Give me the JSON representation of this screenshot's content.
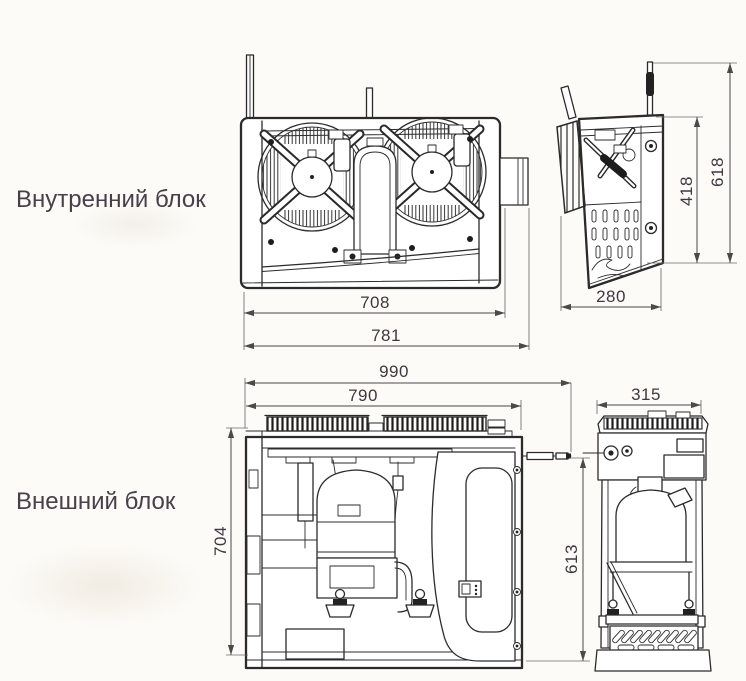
{
  "canvas": {
    "background": "#fcfbf8"
  },
  "drawing": {
    "line_color": "#2b2b2b",
    "dim_line_color": "#4a4a4a",
    "text_color": "#3e3840"
  },
  "sections": {
    "indoor": {
      "label": "Внутренний блок",
      "dimensions": {
        "front_width_inner": "708",
        "front_width_overall": "781",
        "side_depth": "280",
        "side_height_body": "418",
        "side_height_overall": "618"
      }
    },
    "outdoor": {
      "label": "Внешний блок",
      "dimensions": {
        "front_width_overall": "990",
        "front_width_body": "790",
        "front_height_left": "704",
        "front_height_right": "613",
        "side_depth": "315"
      }
    }
  }
}
